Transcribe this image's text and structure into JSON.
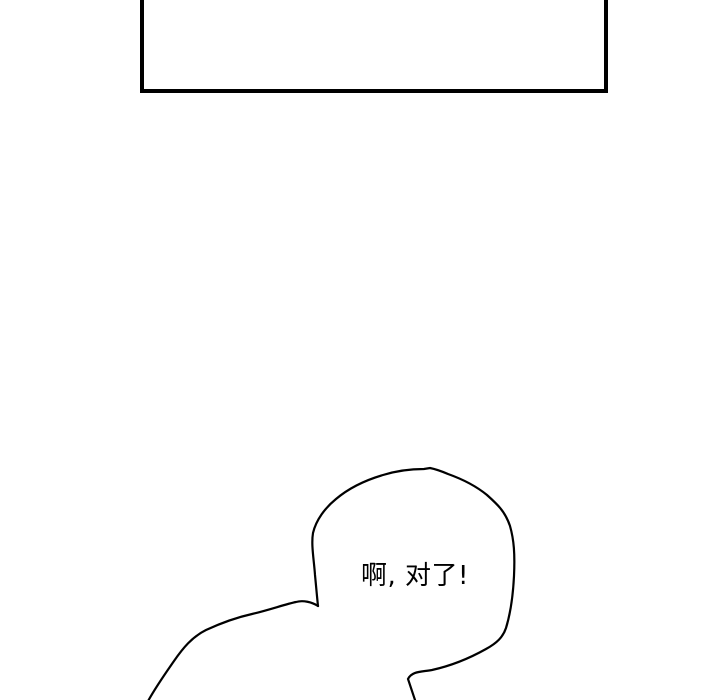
{
  "scene": {
    "background_color": "#ffffff",
    "line_color": "#000000"
  },
  "panel": {
    "border_color": "#000000"
  },
  "speech_bubble": {
    "text": "啊, 对了!",
    "text_color": "#000000",
    "fill_color": "#ffffff",
    "outline_color": "#000000"
  }
}
